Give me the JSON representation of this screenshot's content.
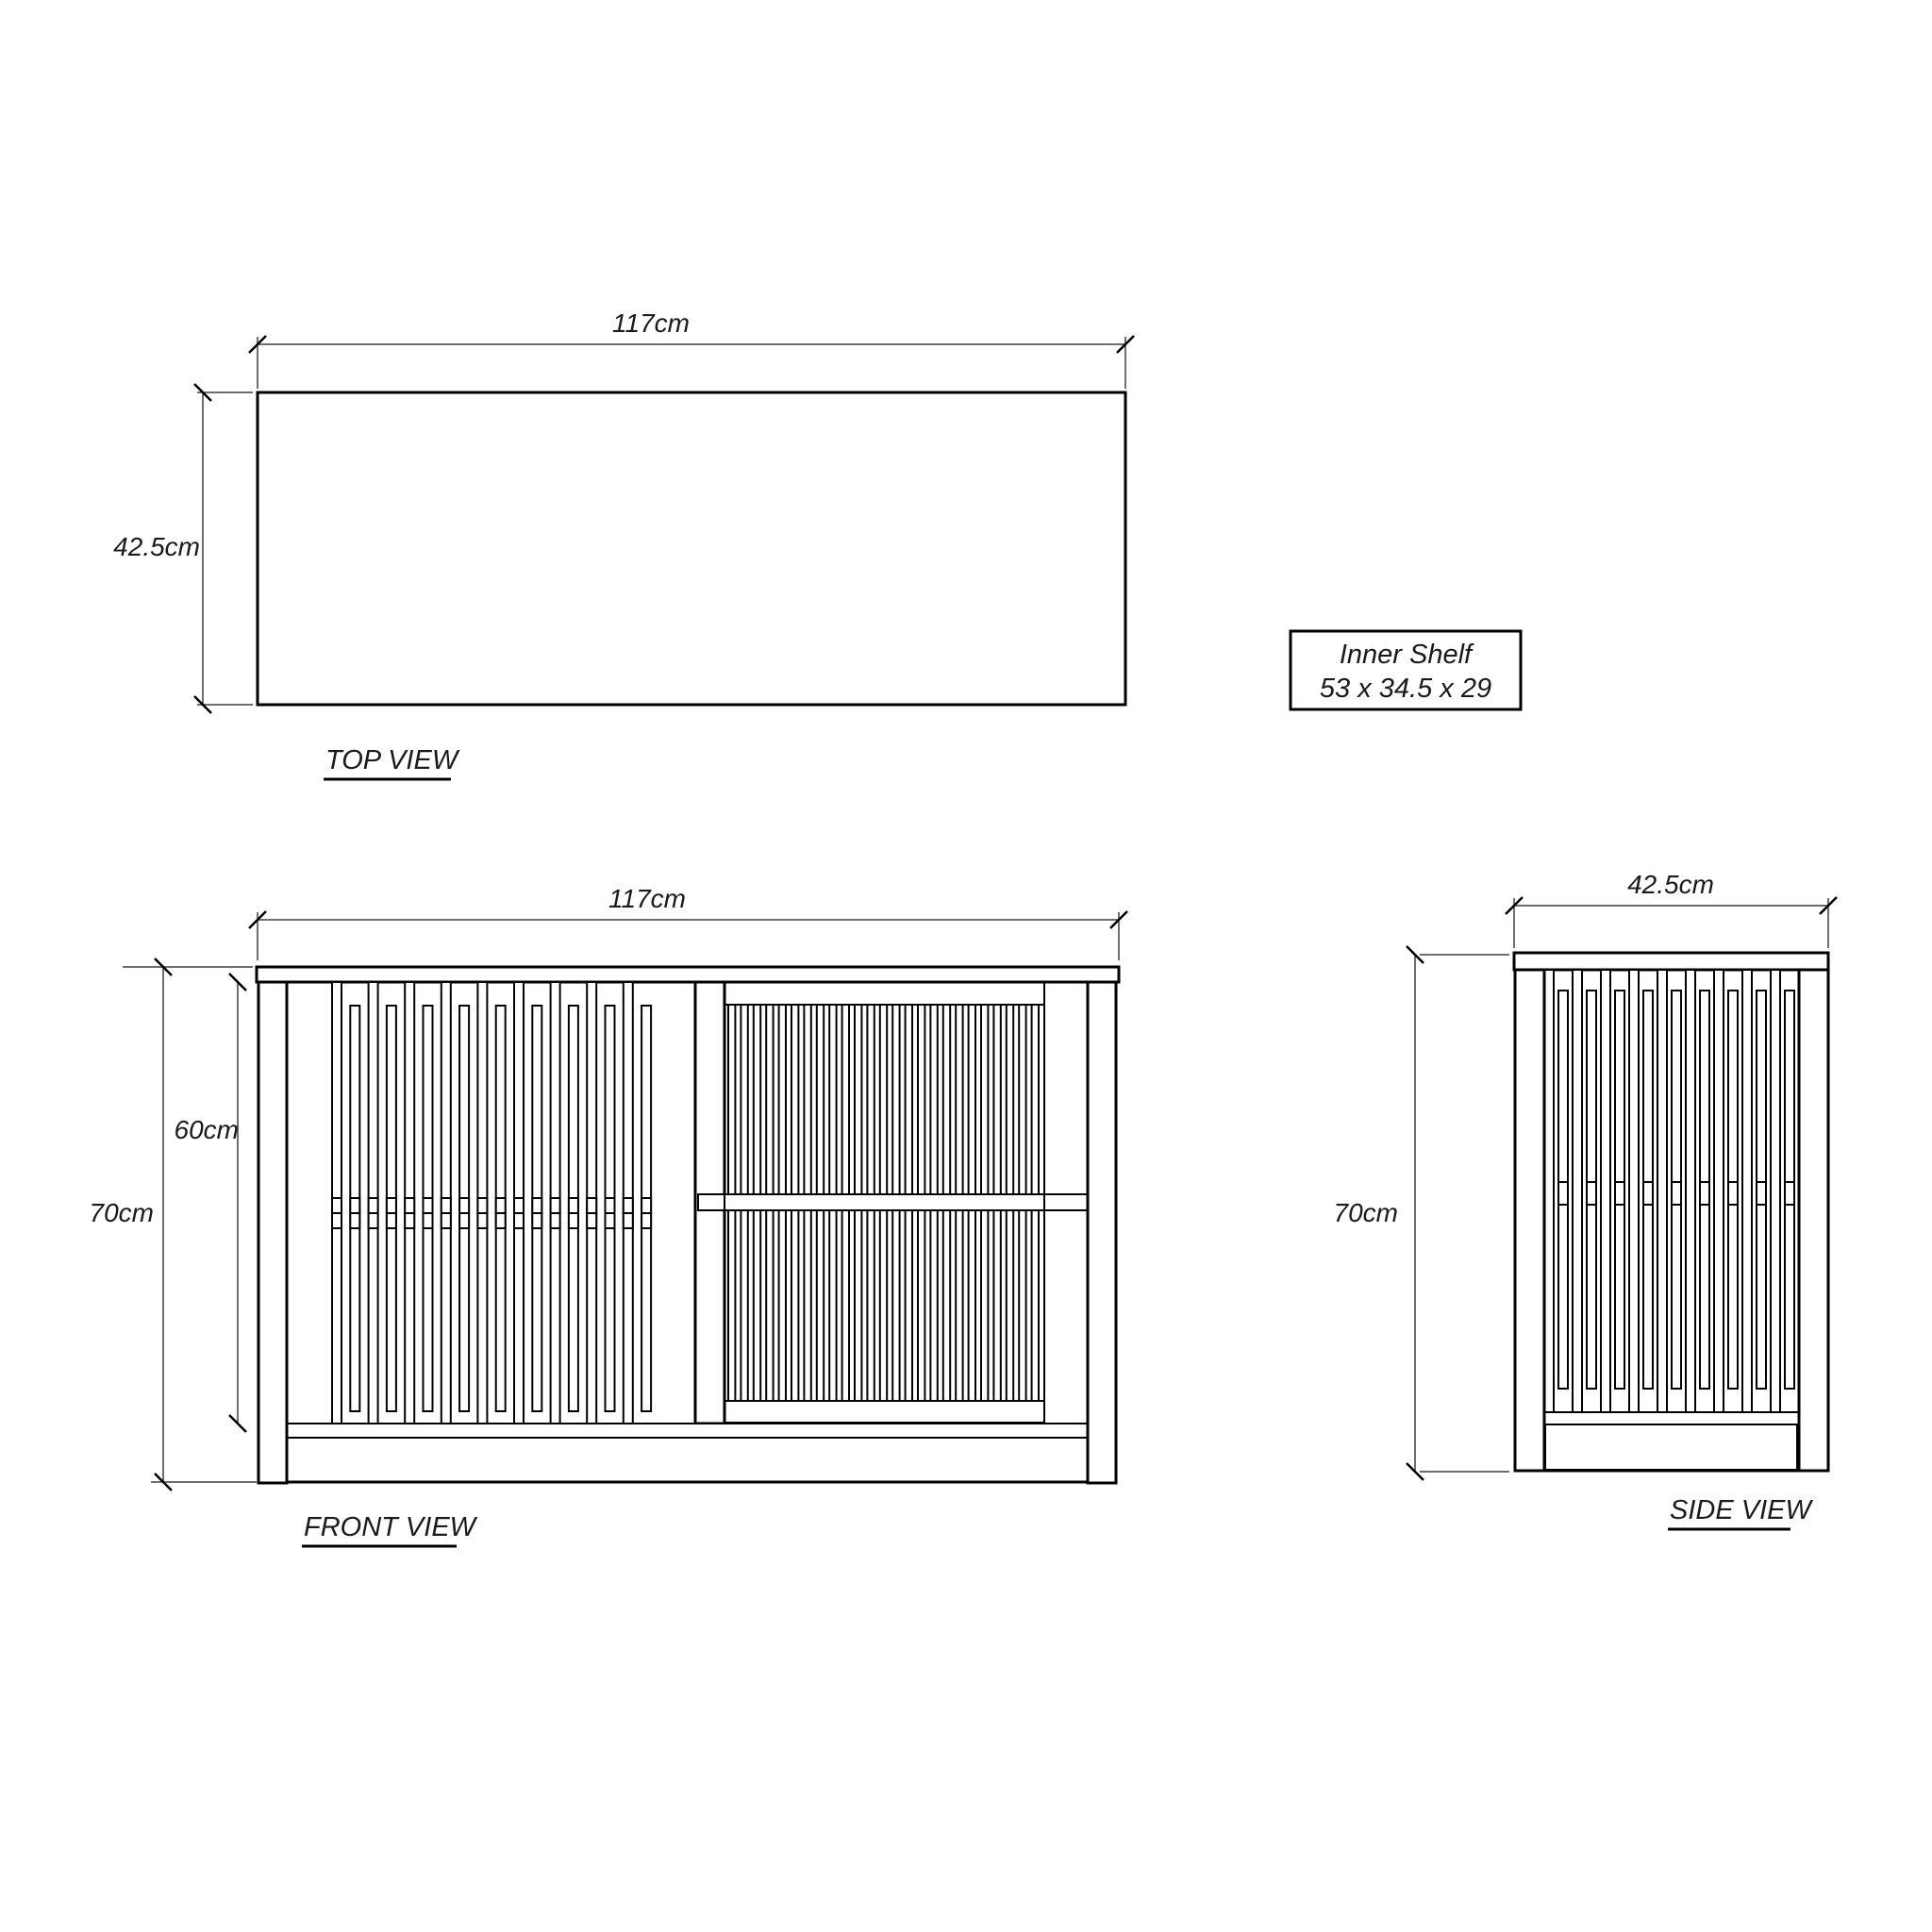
{
  "top_view": {
    "label": "TOP VIEW",
    "width_dim": "117cm",
    "depth_dim": "42.5cm"
  },
  "front_view": {
    "label": "FRONT VIEW",
    "width_dim": "117cm",
    "height_dim": "70cm",
    "inner_height_dim": "60cm"
  },
  "side_view": {
    "label": "SIDE VIEW",
    "width_dim": "42.5cm",
    "height_dim": "70cm"
  },
  "inner_shelf_note": {
    "title": "Inner Shelf",
    "dimensions": "53 x 34.5 x 29"
  },
  "colors": {
    "outline": "#000000",
    "dim_line": "#3f3f3f",
    "text": "#1a1a1a",
    "background": "#ffffff"
  }
}
